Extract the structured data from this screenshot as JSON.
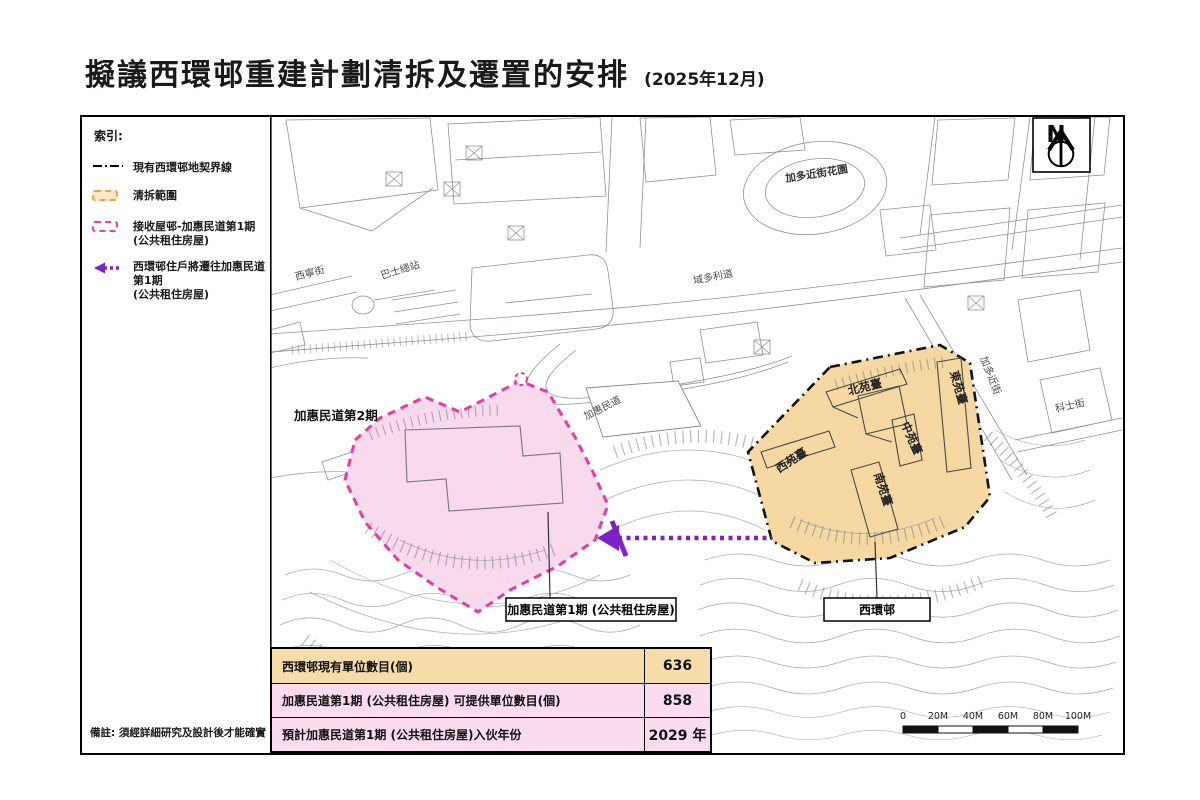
{
  "title": {
    "main": "擬議西環邨重建計劃清拆及遷置的安排",
    "date": "(2025年12月)"
  },
  "legend": {
    "heading": "索引:",
    "items": [
      {
        "label": "現有西環邨地契界線"
      },
      {
        "label": "清拆範圍"
      },
      {
        "label": "接收屋邨-加惠民道第1期",
        "sublabel": "(公共租住房屋)"
      },
      {
        "label": "西環邨住戶將遷往加惠民道第1期",
        "sublabel": "(公共租住房屋)"
      }
    ]
  },
  "map": {
    "streets": {
      "sai_ning": "西寧街",
      "bus_terminus": "巴士總站",
      "victoria_road": "域多利道",
      "cadogan_garden": "加多近街花園",
      "ka_wai_man": "加惠民道",
      "cadogan": "加多近街",
      "forbes": "科士街"
    },
    "areas": {
      "phase2": "加惠民道第2期"
    },
    "callouts": {
      "phase1": "加惠民道第1期 (公共租住房屋)",
      "sai_wan_estate": "西環邨"
    },
    "buildings": {
      "north": "北苑臺",
      "east": "東苑臺",
      "middle": "中苑臺",
      "west": "西苑臺",
      "south": "南苑臺"
    },
    "compass": "N"
  },
  "scale_bar": {
    "labels": [
      "0",
      "20M",
      "40M",
      "60M",
      "80M",
      "100M"
    ]
  },
  "table": {
    "rows": [
      {
        "label": "西環邨現有單位數目(個)",
        "value": "636"
      },
      {
        "label": "加惠民道第1期 (公共租住房屋) 可提供單位數目(個)",
        "value": "858"
      },
      {
        "label": "預計加惠民道第1期 (公共租住房屋)入伙年份",
        "value": "2029 年"
      }
    ]
  },
  "footnote": "備註: 須經詳細研究及設計後才能確實",
  "colors": {
    "demolition_fill": "#F5D8A2",
    "demolition_dash": "#F0A43C",
    "receiving_fill": "#F9D9EC",
    "receiving_dash": "#E93CA2",
    "relocation_arrow": "#7E22C8",
    "boundary_line": "#000000"
  }
}
